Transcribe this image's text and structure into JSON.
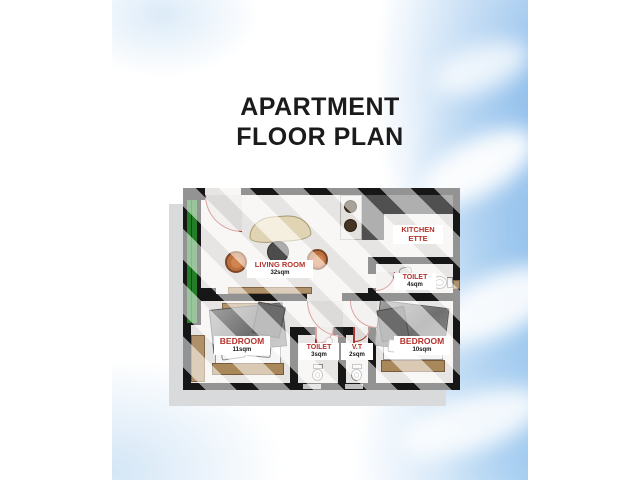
{
  "title": {
    "line1": "APARTMENT",
    "line2": "FLOOR PLAN"
  },
  "rooms": {
    "living": {
      "name": "LIVING ROOM",
      "area": "32sqm"
    },
    "kitchenette": {
      "name_line1": "KITCHEN",
      "name_line2": "ETTE"
    },
    "toilet_main": {
      "name": "TOILET",
      "area": "4sqm"
    },
    "bedroom_left": {
      "name": "BEDROOM",
      "area": "11sqm"
    },
    "toilet_small": {
      "name": "TOILET",
      "area": "3sqm"
    },
    "vt": {
      "name": "V.T",
      "area": "2sqm"
    },
    "bedroom_right": {
      "name": "BEDROOM",
      "area": "10sqm"
    }
  },
  "colors": {
    "wall": "#101010",
    "label_red": "#b3322c",
    "balcony_door_green": "#1e7f23",
    "wood_tan": "#b3936a",
    "counter_gray": "#4e4e4e",
    "floor": "#efeeec",
    "sky_blue": "#85b8e9",
    "shadow_gray": "#d9dadb"
  }
}
